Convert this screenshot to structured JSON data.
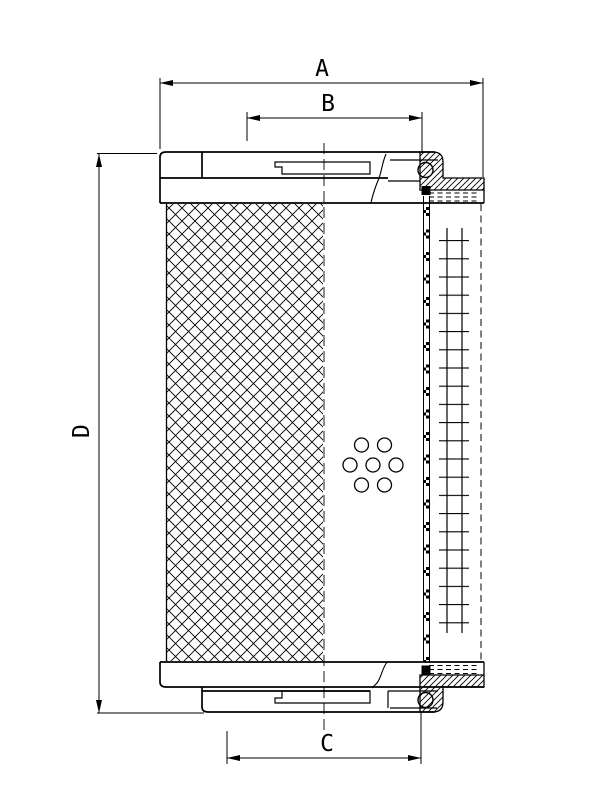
{
  "colors": {
    "line": "#000000",
    "background": "#ffffff"
  },
  "drawing": {
    "labels": {
      "A": "A",
      "B": "B",
      "C": "C",
      "D": "D"
    }
  }
}
